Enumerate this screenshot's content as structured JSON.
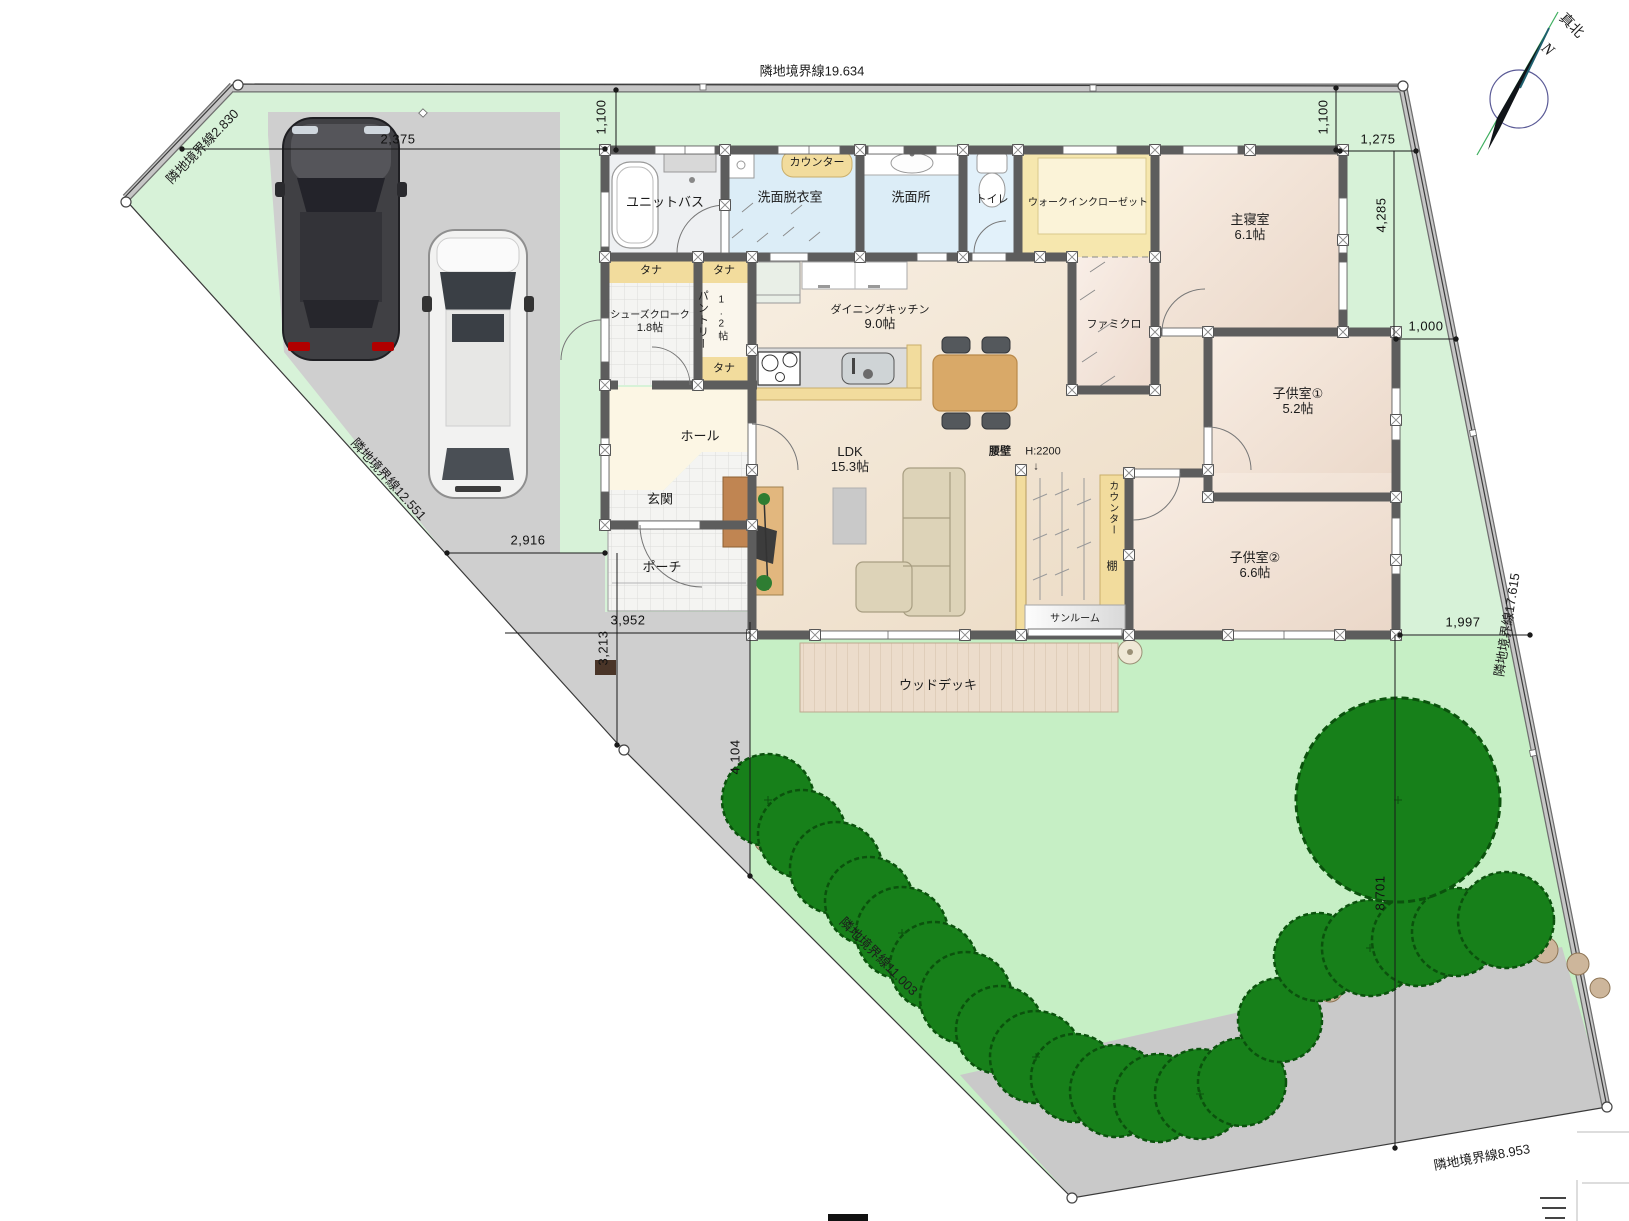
{
  "compass": {
    "true_north": "真北",
    "n": "N"
  },
  "boundaries": {
    "north": "隣地境界線19.634",
    "northwest": "隣地境界線2.830",
    "west": "隣地境界線12.551",
    "southwest": "隣地境界線11.003",
    "south": "隣地境界線8.953",
    "east": "隣地境界線17.615"
  },
  "dimensions": {
    "nw_offset": "2,375",
    "n_left_offset": "1,100",
    "n_right_offset": "1,100",
    "e_top": "1,275",
    "e_mid": "4,285",
    "e_low": "1,000",
    "w_mid": "2,916",
    "sw_width": "3,952",
    "sw_left": "3,213",
    "sw_height": "4,104",
    "se_width": "1,997",
    "se_height": "8,701"
  },
  "rooms": {
    "unit_bath": {
      "name": "ユニットバス"
    },
    "laundry": {
      "name": "洗面脱衣室",
      "counter": "カウンター"
    },
    "washroom": {
      "name": "洗面所"
    },
    "toilet": {
      "name": "トイレ"
    },
    "wic": {
      "name": "ウォークインクローゼット"
    },
    "master": {
      "name": "主寝室",
      "size": "6.1帖"
    },
    "famiclo": {
      "name": "ファミクロ"
    },
    "shoes_closet": {
      "name": "シューズクローク",
      "size": "1.8帖"
    },
    "pantry": {
      "name": "パントリー",
      "size": "1.2帖"
    },
    "dining_kitchen": {
      "name": "ダイニングキッチン",
      "size": "9.0帖"
    },
    "ldk": {
      "name": "LDK",
      "size": "15.3帖"
    },
    "hall": {
      "name": "ホール"
    },
    "entrance": {
      "name": "玄関"
    },
    "porch": {
      "name": "ポーチ"
    },
    "kids1": {
      "name": "子供室①",
      "size": "5.2帖"
    },
    "kids2": {
      "name": "子供室②",
      "size": "6.6帖"
    },
    "sunroom": {
      "name": "サンルーム"
    },
    "wood_deck": {
      "name": "ウッドデッキ"
    }
  },
  "fixtures": {
    "tana": "タナ",
    "counter_vertical": "カウンター",
    "shelf": "棚",
    "half_wall": "腰壁",
    "half_wall_height": "H:2200",
    "half_wall_arrow": "↓"
  },
  "colors": {
    "site_green": "#d7f2d8",
    "lawn_green": "#c6efc5",
    "pavement_gray": "#cfcfcf",
    "wall_gray": "#5d5d5d",
    "water_blue": "#dcedf7",
    "closet_yellow": "#f6e7ae",
    "counter_yellow": "#f2dc9d",
    "deck_tan": "#ecdccb",
    "tree_green": "#17801a",
    "rock_tan": "#cdb69b",
    "taillight_red": "#b00000"
  }
}
